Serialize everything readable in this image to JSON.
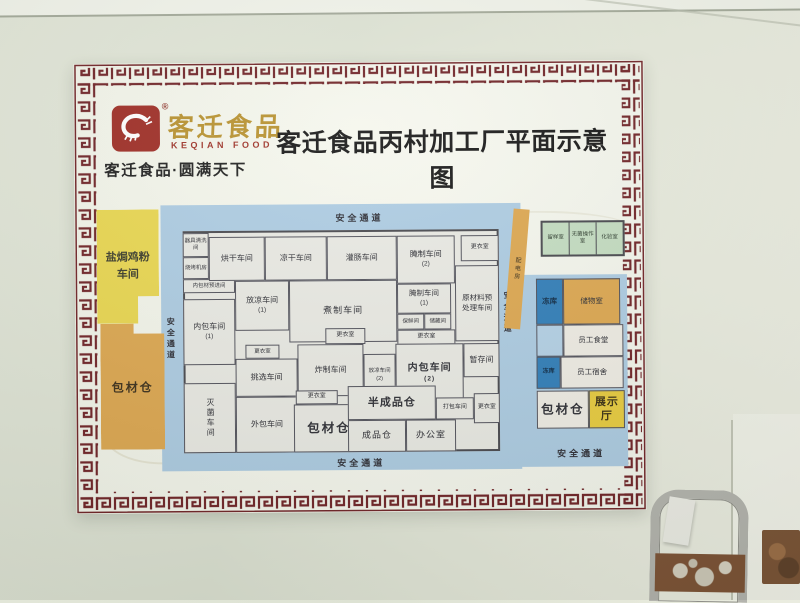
{
  "header": {
    "brand_cn": "客迁食品",
    "brand_en": "KEQIAN FOOD",
    "registered": "®",
    "tagline": "客迁食品·圆满天下",
    "title": "客迁食品丙村加工厂平面示意图"
  },
  "plan": {
    "passages": {
      "top": "安全通道",
      "bottom": "安全通道",
      "left": "安全通道",
      "right": "安全通道",
      "bottom_right": "安全通道"
    },
    "left_blocks": {
      "salt_baked_chicken": "盐焗鸡粉车间",
      "pack_material": "包材仓"
    },
    "rooms": {
      "utensil_wash": "器具清洗间",
      "bbq_machine": "烧烤机房",
      "inner_pack_pre": "内包材预进间",
      "drying": "烘干车间",
      "cool_dry": "凉干车间",
      "sausage": "灌肠车间",
      "curing": "腌制车间",
      "changing": "更衣室",
      "cooling": "放凉车间",
      "boiling": "煮制车间",
      "fresh_keep": "保鲜间",
      "storage_small": "储藏间",
      "raw_pre": "原材料预处理车间",
      "inner_pack": "内包车间",
      "sorting": "挑选车间",
      "frying": "炸制车间",
      "temp_store": "暂存间",
      "sterilize": "灭菌车间",
      "outer_pack": "外包车间",
      "pack_store": "包材仓",
      "semi_finished": "半成品仓",
      "finished": "成品仓",
      "office": "办公室",
      "packing": "打包车间",
      "power": "配电房",
      "sample": "留样室",
      "sterile_op": "无菌操作室",
      "lab": "化验室",
      "freezer": "冻库",
      "storage_room": "储物室",
      "canteen": "员工食堂",
      "dorm": "员工宿舍",
      "showroom": "展示厅"
    },
    "subs": {
      "one": "(1)",
      "two": "(2)"
    }
  },
  "colors": {
    "brand_red": "#9d2a22",
    "brand_gold": "#b7902c",
    "frame_maroon": "#6e2024",
    "passage_blue": "#accbe2",
    "freezer_blue": "#2e7cb8",
    "warehouse_orange": "#dda64e",
    "workshop_yellow": "#e9d64e",
    "lab_green": "#c3dcc0",
    "showroom_yellow": "#e8cb3c"
  }
}
